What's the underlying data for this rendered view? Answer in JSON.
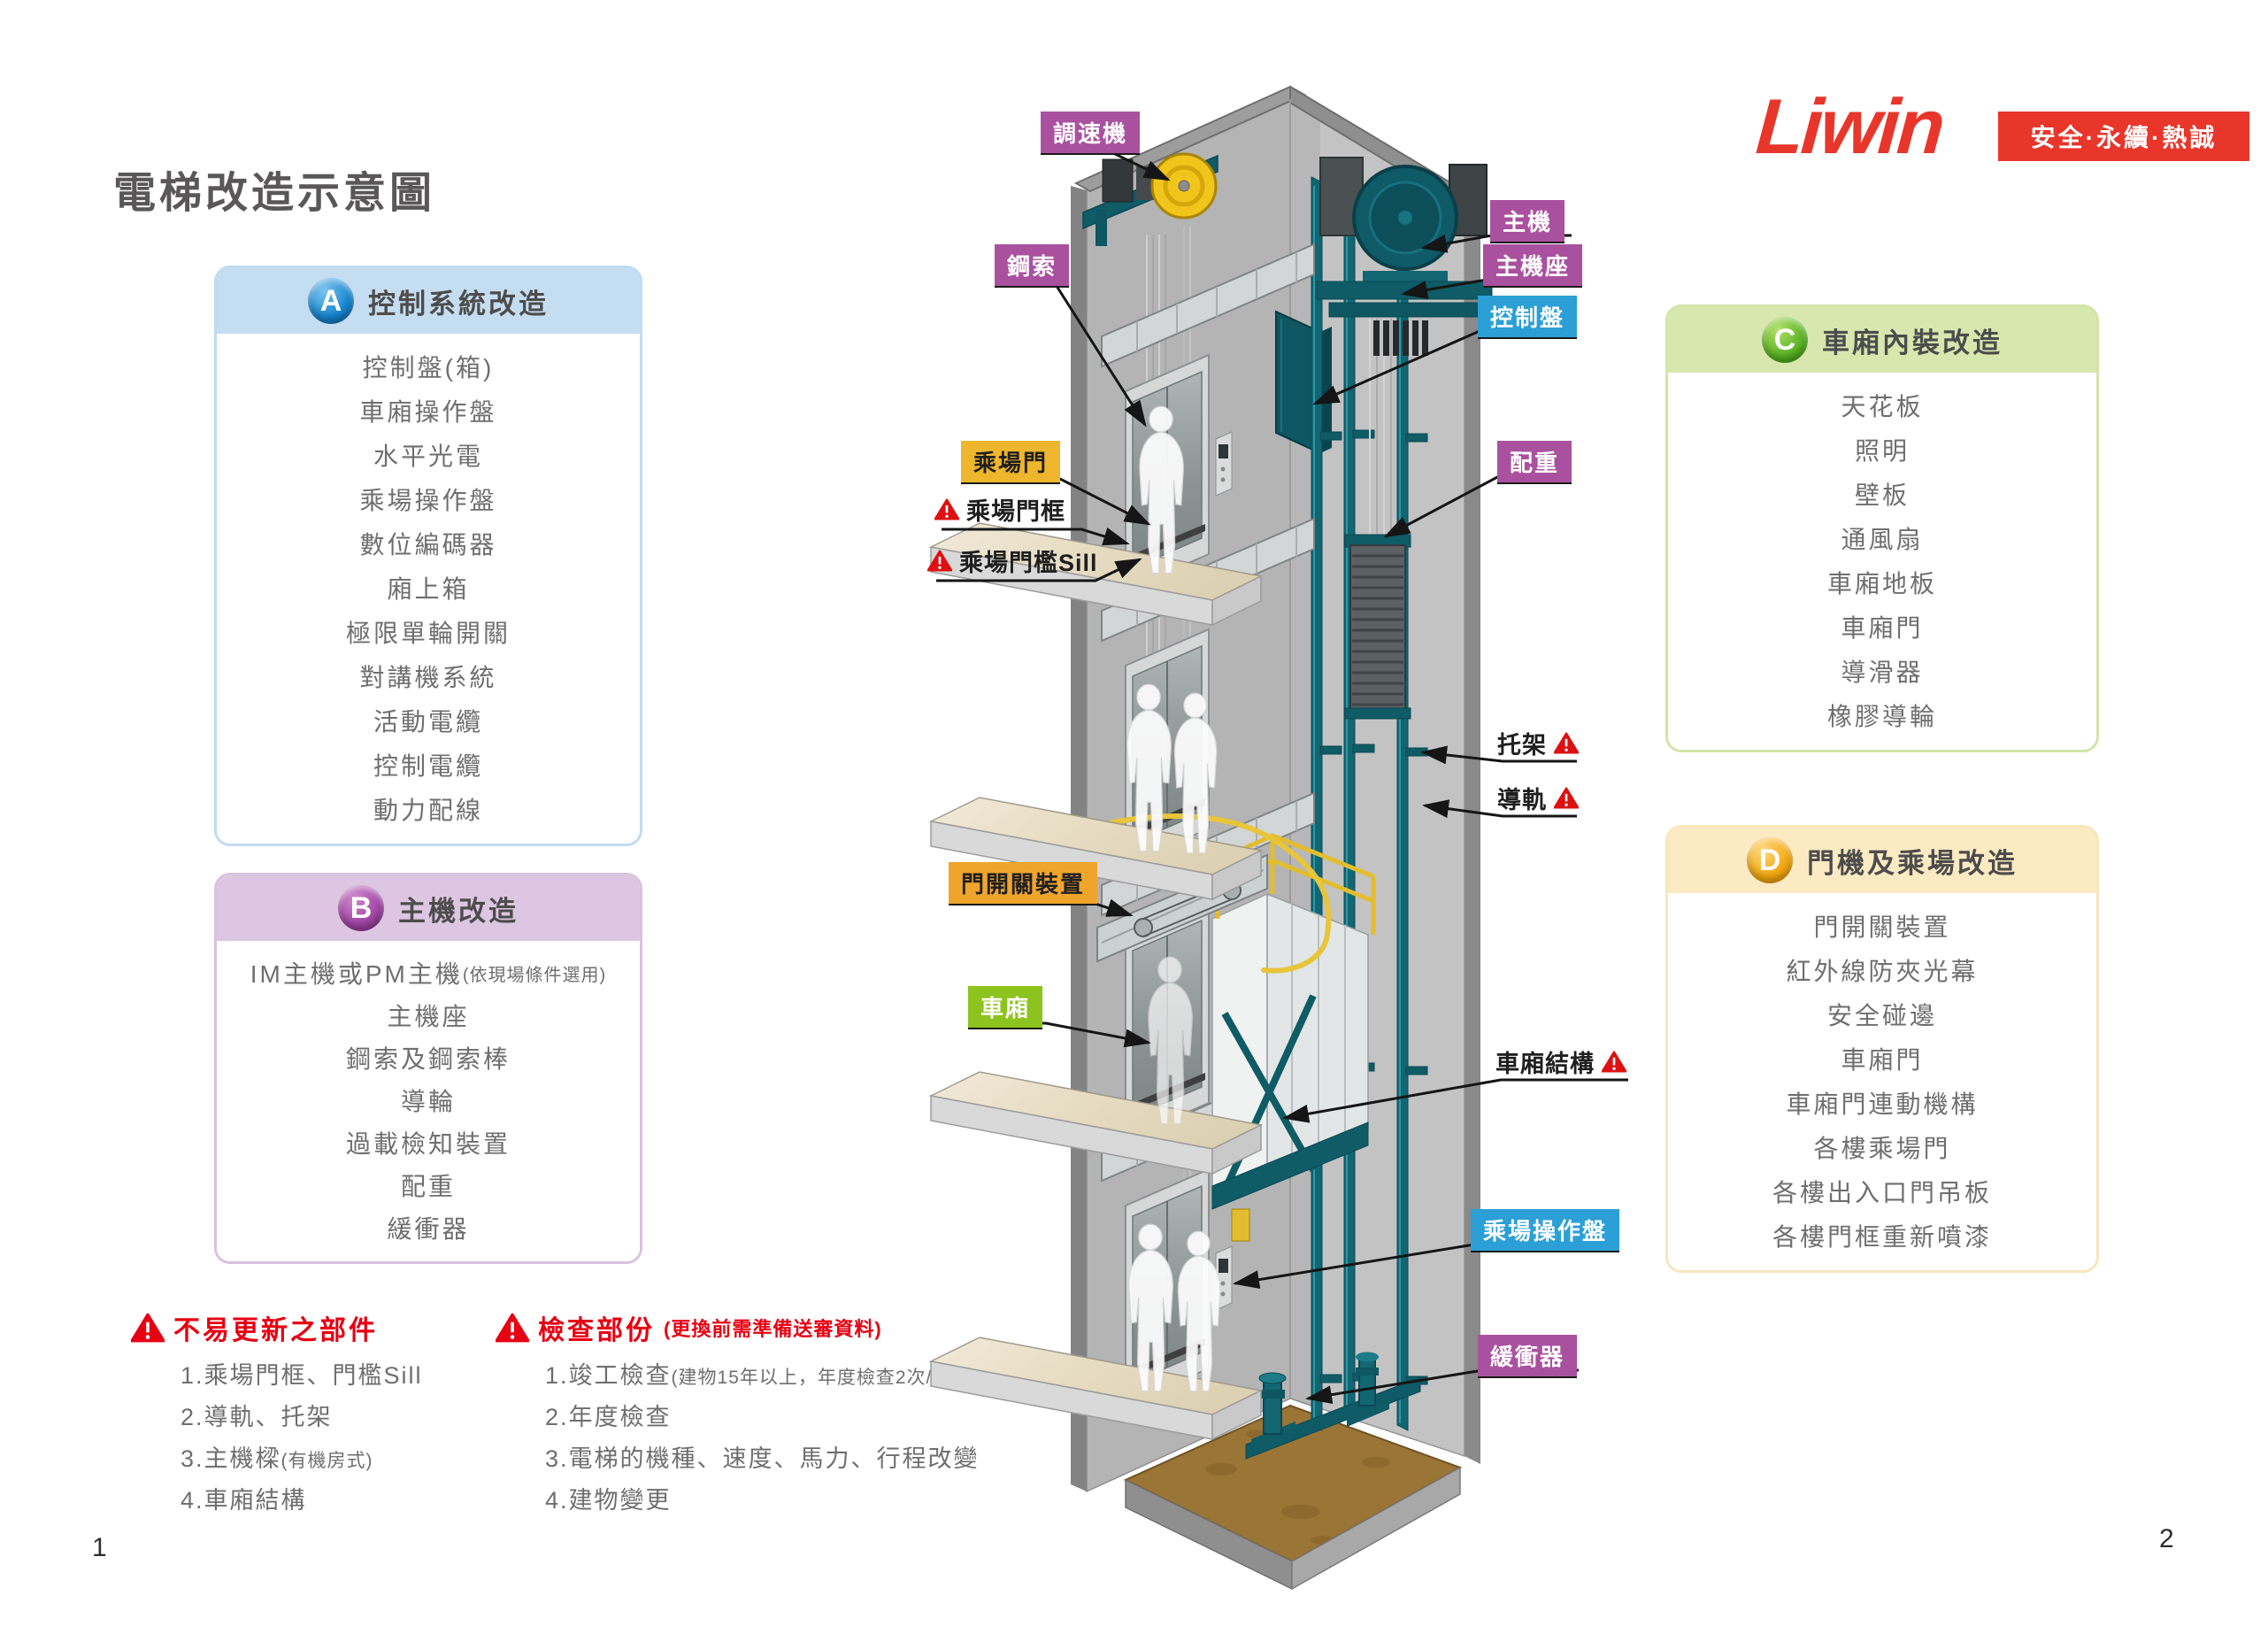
{
  "page": {
    "title": "電梯改造示意圖",
    "page_left": "1",
    "page_right": "2"
  },
  "brand": {
    "logo": "Liwin",
    "tagline": "安全·永續·熱誠"
  },
  "panel_a": {
    "letter": "A",
    "title": "控制系統改造",
    "items": [
      "控制盤(箱)",
      "車廂操作盤",
      "水平光電",
      "乘場操作盤",
      "數位編碼器",
      "廂上箱",
      "極限單輪開關",
      "對講機系統",
      "活動電纜",
      "控制電纜",
      "動力配線"
    ]
  },
  "panel_b": {
    "letter": "B",
    "title": "主機改造",
    "items": [
      {
        "main": "IM主機或PM主機",
        "small": "(依現場條件選用)"
      },
      {
        "main": "主機座",
        "small": ""
      },
      {
        "main": "鋼索及鋼索棒",
        "small": ""
      },
      {
        "main": "導輪",
        "small": ""
      },
      {
        "main": "過載檢知裝置",
        "small": ""
      },
      {
        "main": "配重",
        "small": ""
      },
      {
        "main": "緩衝器",
        "small": ""
      }
    ]
  },
  "panel_c": {
    "letter": "C",
    "title": "車廂內裝改造",
    "items": [
      "天花板",
      "照明",
      "壁板",
      "通風扇",
      "車廂地板",
      "車廂門",
      "導滑器",
      "橡膠導輪"
    ]
  },
  "panel_d": {
    "letter": "D",
    "title": "門機及乘場改造",
    "items": [
      "門開關裝置",
      "紅外線防夾光幕",
      "安全碰邊",
      "車廂門",
      "車廂門連動機構",
      "各樓乘場門",
      "各樓出入口門吊板",
      "各樓門框重新噴漆"
    ]
  },
  "warning_left": {
    "title": "不易更新之部件",
    "items": [
      {
        "main": "1.乘場門框、門檻Sill",
        "small": ""
      },
      {
        "main": "2.導軌、托架",
        "small": ""
      },
      {
        "main": "3.主機樑",
        "small": "(有機房式)"
      },
      {
        "main": "4.車廂結構",
        "small": ""
      }
    ]
  },
  "warning_right": {
    "title": "檢查部份",
    "subtitle": "(更換前需準備送審資料)",
    "items": [
      {
        "main": "1.竣工檢查",
        "small": "(建物15年以上，年度檢查2次/年)"
      },
      {
        "main": "2.年度檢查",
        "small": ""
      },
      {
        "main": "3.電梯的機種、速度、馬力、行程改變",
        "small": ""
      },
      {
        "main": "4.建物變更",
        "small": ""
      }
    ]
  },
  "diagram": {
    "labels": {
      "governor": "調速機",
      "rope": "鋼索",
      "machine": "主機",
      "machine_base": "主機座",
      "control_panel": "控制盤",
      "landing_door": "乘場門",
      "landing_door_frame": "乘場門框",
      "landing_sill": "乘場門檻Sill",
      "counterweight": "配重",
      "bracket": "托架",
      "guide_rail": "導軌",
      "door_operator": "門開關裝置",
      "car": "車廂",
      "car_structure": "車廂結構",
      "hall_panel": "乘場操作盤",
      "buffer": "緩衝器"
    }
  },
  "colors": {
    "brand_red": "#e8362b",
    "warning_red": "#e60012",
    "teal": "#116672"
  }
}
